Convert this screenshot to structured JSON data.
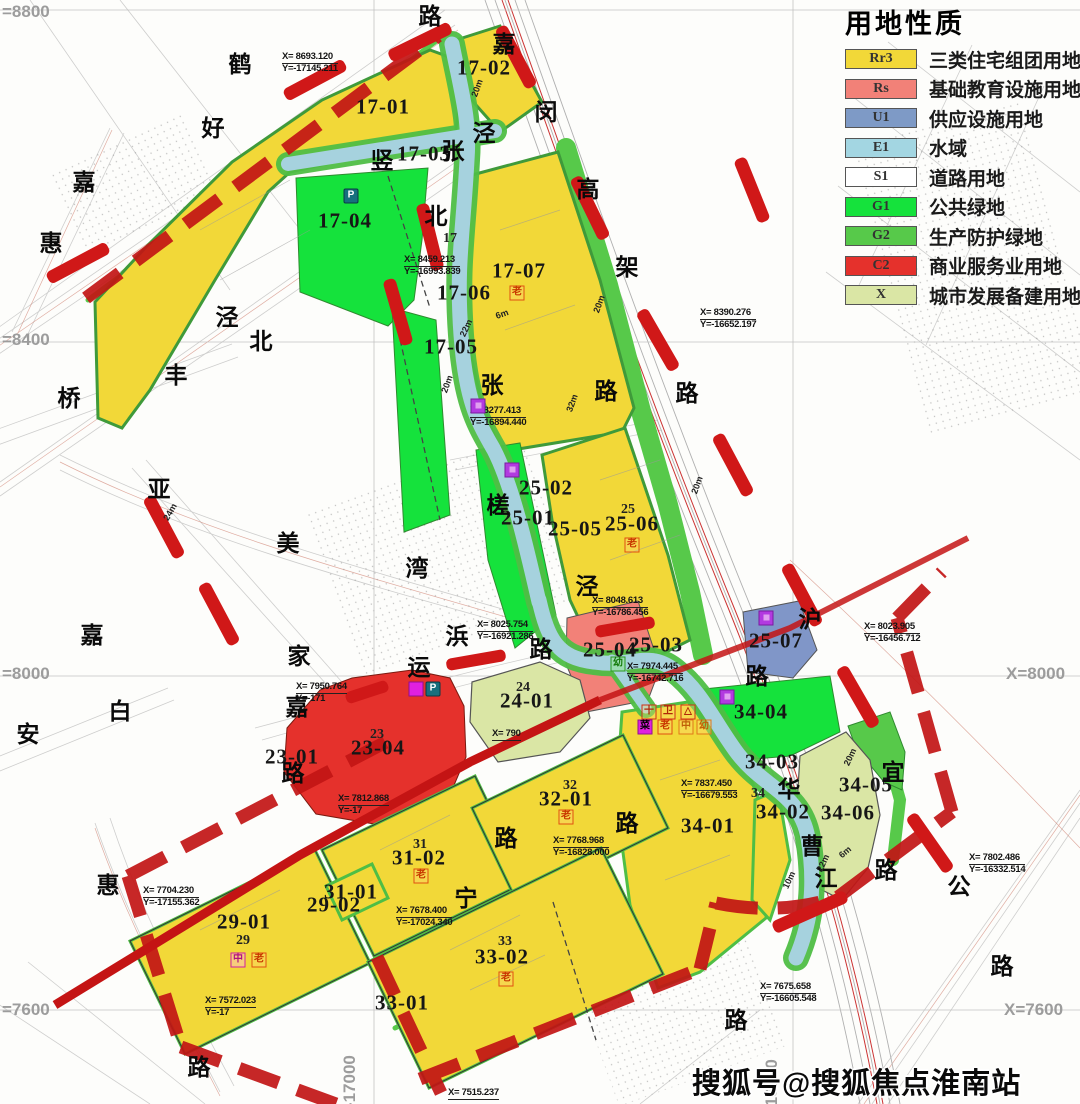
{
  "legend": {
    "title": "用地性质",
    "items": [
      {
        "code": "Rr3",
        "label": "三类住宅组团用地",
        "color": "#F2D838"
      },
      {
        "code": "Rs",
        "label": "基础教育设施用地",
        "color": "#F28178"
      },
      {
        "code": "U1",
        "label": "供应设施用地",
        "color": "#7E9AC6"
      },
      {
        "code": "E1",
        "label": "水域",
        "color": "#A3D6E2"
      },
      {
        "code": "S1",
        "label": "道路用地",
        "color": "#FFFFFF"
      },
      {
        "code": "G1",
        "label": "公共绿地",
        "color": "#15E23C"
      },
      {
        "code": "G2",
        "label": "生产防护绿地",
        "color": "#57C94A"
      },
      {
        "code": "C2",
        "label": "商业服务业用地",
        "color": "#E5312C"
      },
      {
        "code": "X",
        "label": "城市发展备建用地",
        "color": "#DAE6A5"
      }
    ]
  },
  "watermark": "搜狐号@搜狐焦点淮南站",
  "parcel_labels": [
    {
      "t": "17-01",
      "x": 383,
      "y": 107
    },
    {
      "t": "17-02",
      "x": 484,
      "y": 68
    },
    {
      "t": "17-03",
      "x": 424,
      "y": 154
    },
    {
      "t": "17-04",
      "x": 345,
      "y": 221
    },
    {
      "t": "17-05",
      "x": 451,
      "y": 347
    },
    {
      "t": "17-06",
      "x": 464,
      "y": 293
    },
    {
      "t": "17-07",
      "x": 519,
      "y": 271
    },
    {
      "t": "25-02",
      "x": 546,
      "y": 488
    },
    {
      "t": "25-01",
      "x": 528,
      "y": 518
    },
    {
      "t": "25-05",
      "x": 575,
      "y": 529
    },
    {
      "t": "25-06",
      "x": 632,
      "y": 524
    },
    {
      "t": "25-03",
      "x": 656,
      "y": 645
    },
    {
      "t": "25-04",
      "x": 610,
      "y": 650
    },
    {
      "t": "25-07",
      "x": 776,
      "y": 641
    },
    {
      "t": "23-01",
      "x": 292,
      "y": 757
    },
    {
      "t": "23-04",
      "x": 378,
      "y": 748
    },
    {
      "t": "24-01",
      "x": 527,
      "y": 701
    },
    {
      "t": "31-01",
      "x": 351,
      "y": 892
    },
    {
      "t": "31-02",
      "x": 419,
      "y": 858
    },
    {
      "t": "29-02",
      "x": 334,
      "y": 905
    },
    {
      "t": "29-01",
      "x": 244,
      "y": 922
    },
    {
      "t": "32-01",
      "x": 566,
      "y": 799
    },
    {
      "t": "33-01",
      "x": 402,
      "y": 1003
    },
    {
      "t": "33-02",
      "x": 502,
      "y": 957
    },
    {
      "t": "34-01",
      "x": 708,
      "y": 826
    },
    {
      "t": "34-02",
      "x": 783,
      "y": 812
    },
    {
      "t": "34-03",
      "x": 772,
      "y": 762
    },
    {
      "t": "34-04",
      "x": 761,
      "y": 712
    },
    {
      "t": "34-05",
      "x": 866,
      "y": 785
    },
    {
      "t": "34-06",
      "x": 848,
      "y": 813
    }
  ],
  "small_labels": [
    {
      "t": "17",
      "x": 450,
      "y": 239
    },
    {
      "t": "25",
      "x": 628,
      "y": 510
    },
    {
      "t": "24",
      "x": 523,
      "y": 688
    },
    {
      "t": "23",
      "x": 377,
      "y": 735
    },
    {
      "t": "29",
      "x": 243,
      "y": 941
    },
    {
      "t": "31",
      "x": 420,
      "y": 845
    },
    {
      "t": "32",
      "x": 570,
      "y": 786
    },
    {
      "t": "33",
      "x": 505,
      "y": 942
    },
    {
      "t": "34",
      "x": 758,
      "y": 794
    }
  ],
  "road_chars": [
    {
      "t": "路",
      "x": 430,
      "y": 14
    },
    {
      "t": "嘉",
      "x": 504,
      "y": 42
    },
    {
      "t": "闵",
      "x": 546,
      "y": 110
    },
    {
      "t": "鹤",
      "x": 240,
      "y": 62
    },
    {
      "t": "好",
      "x": 213,
      "y": 126
    },
    {
      "t": "泾",
      "x": 484,
      "y": 131
    },
    {
      "t": "张",
      "x": 453,
      "y": 149
    },
    {
      "t": "竖",
      "x": 382,
      "y": 158
    },
    {
      "t": "北",
      "x": 436,
      "y": 214
    },
    {
      "t": "高",
      "x": 588,
      "y": 187
    },
    {
      "t": "架",
      "x": 627,
      "y": 265
    },
    {
      "t": "路",
      "x": 606,
      "y": 389
    },
    {
      "t": "路",
      "x": 687,
      "y": 391
    },
    {
      "t": "张",
      "x": 492,
      "y": 383
    },
    {
      "t": "嘉",
      "x": 84,
      "y": 180
    },
    {
      "t": "惠",
      "x": 51,
      "y": 241
    },
    {
      "t": "泾",
      "x": 227,
      "y": 315
    },
    {
      "t": "北",
      "x": 261,
      "y": 339
    },
    {
      "t": "丰",
      "x": 176,
      "y": 373
    },
    {
      "t": "桥",
      "x": 69,
      "y": 396
    },
    {
      "t": "亚",
      "x": 159,
      "y": 487
    },
    {
      "t": "美",
      "x": 288,
      "y": 541
    },
    {
      "t": "湾",
      "x": 417,
      "y": 566
    },
    {
      "t": "槎",
      "x": 498,
      "y": 503
    },
    {
      "t": "泾",
      "x": 587,
      "y": 584
    },
    {
      "t": "浜",
      "x": 457,
      "y": 634
    },
    {
      "t": "家",
      "x": 299,
      "y": 654
    },
    {
      "t": "运",
      "x": 419,
      "y": 665
    },
    {
      "t": "路",
      "x": 541,
      "y": 647
    },
    {
      "t": "嘉",
      "x": 297,
      "y": 705
    },
    {
      "t": "路",
      "x": 293,
      "y": 771
    },
    {
      "t": "白",
      "x": 120,
      "y": 709
    },
    {
      "t": "安",
      "x": 28,
      "y": 732
    },
    {
      "t": "嘉",
      "x": 92,
      "y": 633
    },
    {
      "t": "惠",
      "x": 108,
      "y": 883
    },
    {
      "t": "路",
      "x": 199,
      "y": 1065
    },
    {
      "t": "宁",
      "x": 466,
      "y": 896
    },
    {
      "t": "路",
      "x": 506,
      "y": 836
    },
    {
      "t": "路",
      "x": 627,
      "y": 821
    },
    {
      "t": "宜",
      "x": 893,
      "y": 770
    },
    {
      "t": "华",
      "x": 789,
      "y": 787
    },
    {
      "t": "曹",
      "x": 812,
      "y": 844
    },
    {
      "t": "江",
      "x": 826,
      "y": 876
    },
    {
      "t": "路",
      "x": 886,
      "y": 868
    },
    {
      "t": "公",
      "x": 959,
      "y": 884
    },
    {
      "t": "路",
      "x": 1002,
      "y": 964
    },
    {
      "t": "路",
      "x": 736,
      "y": 1018
    },
    {
      "t": "沪",
      "x": 810,
      "y": 617
    },
    {
      "t": "路",
      "x": 757,
      "y": 674
    }
  ],
  "coords": [
    {
      "t1": "X=  8693.120",
      "t2": "Y=-17145.211",
      "x": 282,
      "y": 52
    },
    {
      "t1": "X=  8459.213",
      "t2": "Y=-16993.839",
      "x": 404,
      "y": 255
    },
    {
      "t1": "X=  8277.413",
      "t2": "Y=-16894.440",
      "x": 470,
      "y": 406
    },
    {
      "t1": "X=  8390.276",
      "t2": "Y=-16652.197",
      "x": 700,
      "y": 308
    },
    {
      "t1": "X=  8048.613",
      "t2": "Y=-16786.456",
      "x": 592,
      "y": 596
    },
    {
      "t1": "X=  8025.754",
      "t2": "Y=-16921.286",
      "x": 477,
      "y": 620
    },
    {
      "t1": "X=  7974.445",
      "t2": "Y=-16742.716",
      "x": 627,
      "y": 662
    },
    {
      "t1": "X=  8023.905",
      "t2": "Y=-16456.712",
      "x": 864,
      "y": 622
    },
    {
      "t1": "X=  7950.764",
      "t2": "Y=-171",
      "x": 296,
      "y": 682
    },
    {
      "t1": "X=  7812.868",
      "t2": "Y=-17",
      "x": 338,
      "y": 794
    },
    {
      "t1": "X=  7768.968",
      "t2": "Y=-16828.000",
      "x": 553,
      "y": 836
    },
    {
      "t1": "X=  7837.450",
      "t2": "Y=-16679.553",
      "x": 681,
      "y": 779
    },
    {
      "t1": "X=  7704.230",
      "t2": "Y=-17155.362",
      "x": 143,
      "y": 886
    },
    {
      "t1": "X=  7572.023",
      "t2": "Y=-17",
      "x": 205,
      "y": 996
    },
    {
      "t1": "X=  7678.400",
      "t2": "Y=-17024.340",
      "x": 396,
      "y": 906
    },
    {
      "t1": "X=  7802.486",
      "t2": "Y=-16332.514",
      "x": 969,
      "y": 853
    },
    {
      "t1": "X=  7675.658",
      "t2": "Y=-16605.548",
      "x": 760,
      "y": 982
    },
    {
      "t1": "X=  7515.237",
      "t2": "",
      "x": 448,
      "y": 1088
    },
    {
      "t1": "X=  790",
      "t2": "",
      "x": 492,
      "y": 729
    }
  ],
  "grid_labels": [
    {
      "t": "=8800",
      "x": 2,
      "y": 2,
      "v": 0
    },
    {
      "t": "=8400",
      "x": 2,
      "y": 330,
      "v": 0
    },
    {
      "t": "=8000",
      "x": 2,
      "y": 664,
      "v": 0
    },
    {
      "t": "=7600",
      "x": 2,
      "y": 1000,
      "v": 0
    },
    {
      "t": "X=8000",
      "x": 1006,
      "y": 664,
      "v": 0
    },
    {
      "t": "X=7600",
      "x": 1004,
      "y": 1000,
      "v": 0
    },
    {
      "t": "=-17000",
      "x": 360,
      "y": 1098,
      "v": 1
    },
    {
      "t": "=-16500",
      "x": 782,
      "y": 1102,
      "v": 1
    }
  ],
  "width_labels": [
    {
      "t": "20m",
      "x": 477,
      "y": 88,
      "r": -70
    },
    {
      "t": "20m",
      "x": 599,
      "y": 304,
      "r": -70
    },
    {
      "t": "22m",
      "x": 466,
      "y": 328,
      "r": -65
    },
    {
      "t": "6m",
      "x": 502,
      "y": 314,
      "r": -20
    },
    {
      "t": "20m",
      "x": 447,
      "y": 384,
      "r": -70
    },
    {
      "t": "32m",
      "x": 572,
      "y": 403,
      "r": -70
    },
    {
      "t": "24m",
      "x": 170,
      "y": 512,
      "r": -60
    },
    {
      "t": "20m",
      "x": 697,
      "y": 485,
      "r": -70
    },
    {
      "t": "20m",
      "x": 850,
      "y": 757,
      "r": -65
    },
    {
      "t": "22m",
      "x": 823,
      "y": 863,
      "r": -65
    },
    {
      "t": "6m",
      "x": 845,
      "y": 852,
      "r": -40
    },
    {
      "t": "10m",
      "x": 789,
      "y": 880,
      "r": -65
    }
  ],
  "icons": [
    {
      "k": "p",
      "t": "P",
      "x": 351,
      "y": 196
    },
    {
      "k": "p",
      "t": "P",
      "x": 433,
      "y": 689
    },
    {
      "k": "mag",
      "t": "",
      "x": 416,
      "y": 689
    },
    {
      "k": "u1",
      "t": "",
      "x": 478,
      "y": 406
    },
    {
      "k": "u1",
      "t": "",
      "x": 512,
      "y": 470
    },
    {
      "k": "u1",
      "t": "",
      "x": 727,
      "y": 697
    },
    {
      "k": "u1",
      "t": "",
      "x": 766,
      "y": 618
    },
    {
      "k": "elder",
      "t": "老",
      "x": 517,
      "y": 293
    },
    {
      "k": "elder",
      "t": "老",
      "x": 632,
      "y": 545
    },
    {
      "k": "elder",
      "t": "老",
      "x": 566,
      "y": 817
    },
    {
      "k": "elder",
      "t": "老",
      "x": 421,
      "y": 876
    },
    {
      "k": "elder",
      "t": "老",
      "x": 506,
      "y": 979
    },
    {
      "k": "kind",
      "t": "幼",
      "x": 618,
      "y": 664
    },
    {
      "k": "mid",
      "t": "中",
      "x": 238,
      "y": 960
    },
    {
      "k": "elder",
      "t": "老",
      "x": 259,
      "y": 960
    },
    {
      "k": "red",
      "t": "十",
      "x": 649,
      "y": 712
    },
    {
      "k": "red",
      "t": "卫",
      "x": 668,
      "y": 712
    },
    {
      "k": "red",
      "t": "△",
      "x": 688,
      "y": 712
    },
    {
      "k": "mag",
      "t": "菜",
      "x": 645,
      "y": 727
    },
    {
      "k": "elder",
      "t": "老",
      "x": 665,
      "y": 727
    },
    {
      "k": "org",
      "t": "中",
      "x": 686,
      "y": 727
    },
    {
      "k": "org",
      "t": "幼",
      "x": 704,
      "y": 727
    }
  ]
}
